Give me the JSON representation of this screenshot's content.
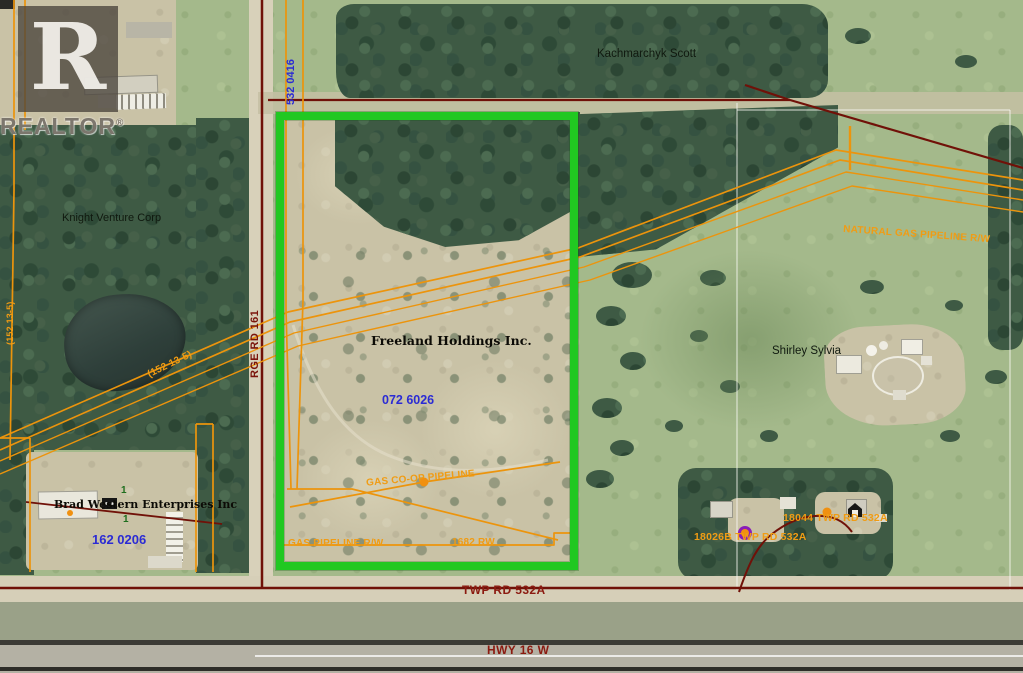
{
  "watermark": {
    "logo_letter": "R",
    "brand": "REALTOR",
    "registered": "®"
  },
  "labels": {
    "owner_kachmarchyk": "Kachmarchyk Scott",
    "owner_knight": "Knight Venture Corp",
    "owner_freeland": "Freeland Holdings Inc.",
    "owner_shirley": "Shirley Sylvia",
    "owner_brad": "Brad Western Enterprises Inc",
    "parcel_532": "532 0416",
    "parcel_072": "072 6026",
    "parcel_162": "162 0206",
    "road_rge": "RGE RD 161",
    "road_twp": "TWP RD 532A",
    "road_hwy": "HWY 16 W",
    "pipe_natural": "NATURAL GAS PIPELINE R/W",
    "pipe_gas": "GAS PIPELINE R/W",
    "pipe_coop": "GAS CO-OP PIPELINE",
    "pipe_1682": "1682 RW",
    "pipe_152": "(152 13-5)",
    "pipe_152b": "(152 13-5)",
    "addr_18044": "18044 TWP RD 532A",
    "addr_18026b": "18026B TWP RD 532A",
    "marker_one_a": "1",
    "marker_one_b": "1"
  },
  "colors": {
    "highlight_green": "#21c821",
    "pipeline_orange": "#ec940c",
    "boundary_maroon": "#701108",
    "parcel_blue": "#2b2bd4",
    "road_red": "#8b1a10"
  }
}
